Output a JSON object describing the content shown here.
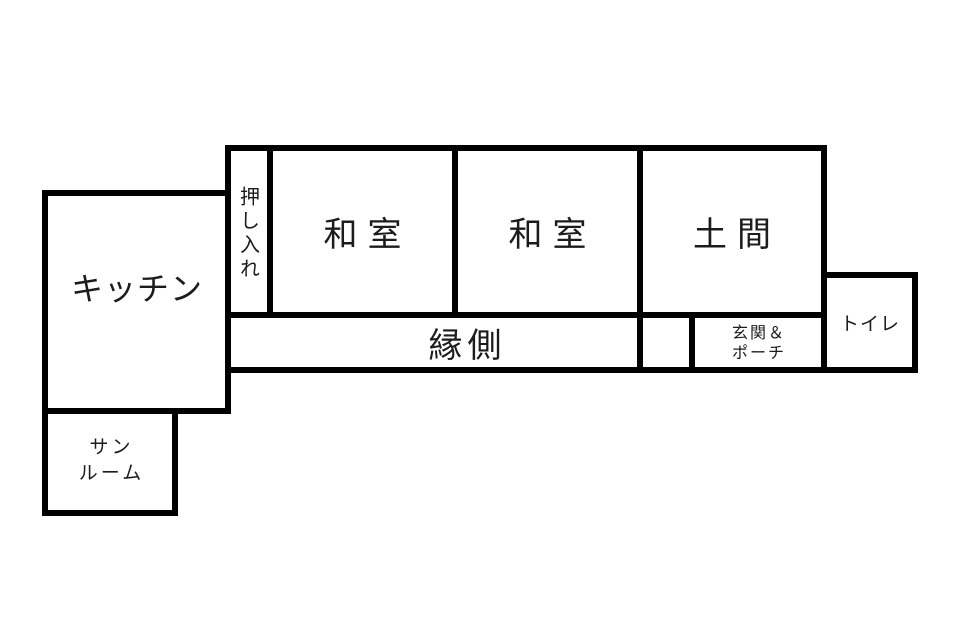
{
  "palette": {
    "background": "#ffffff",
    "wall_color": "#000000",
    "text_color": "#1c1c1c"
  },
  "rooms": {
    "kitchen": {
      "label": "キッチン"
    },
    "closet": {
      "label": "押し入れ"
    },
    "washitsu_left": {
      "label": "和室"
    },
    "washitsu_right": {
      "label": "和室"
    },
    "doma": {
      "label": "土間"
    },
    "engawa": {
      "label": "縁側"
    },
    "genkan_porch": {
      "line1": "玄関＆",
      "line2": "ポーチ"
    },
    "toilet": {
      "label": "トイレ"
    },
    "sunroom": {
      "line1": "サン",
      "line2": "ルーム"
    }
  }
}
